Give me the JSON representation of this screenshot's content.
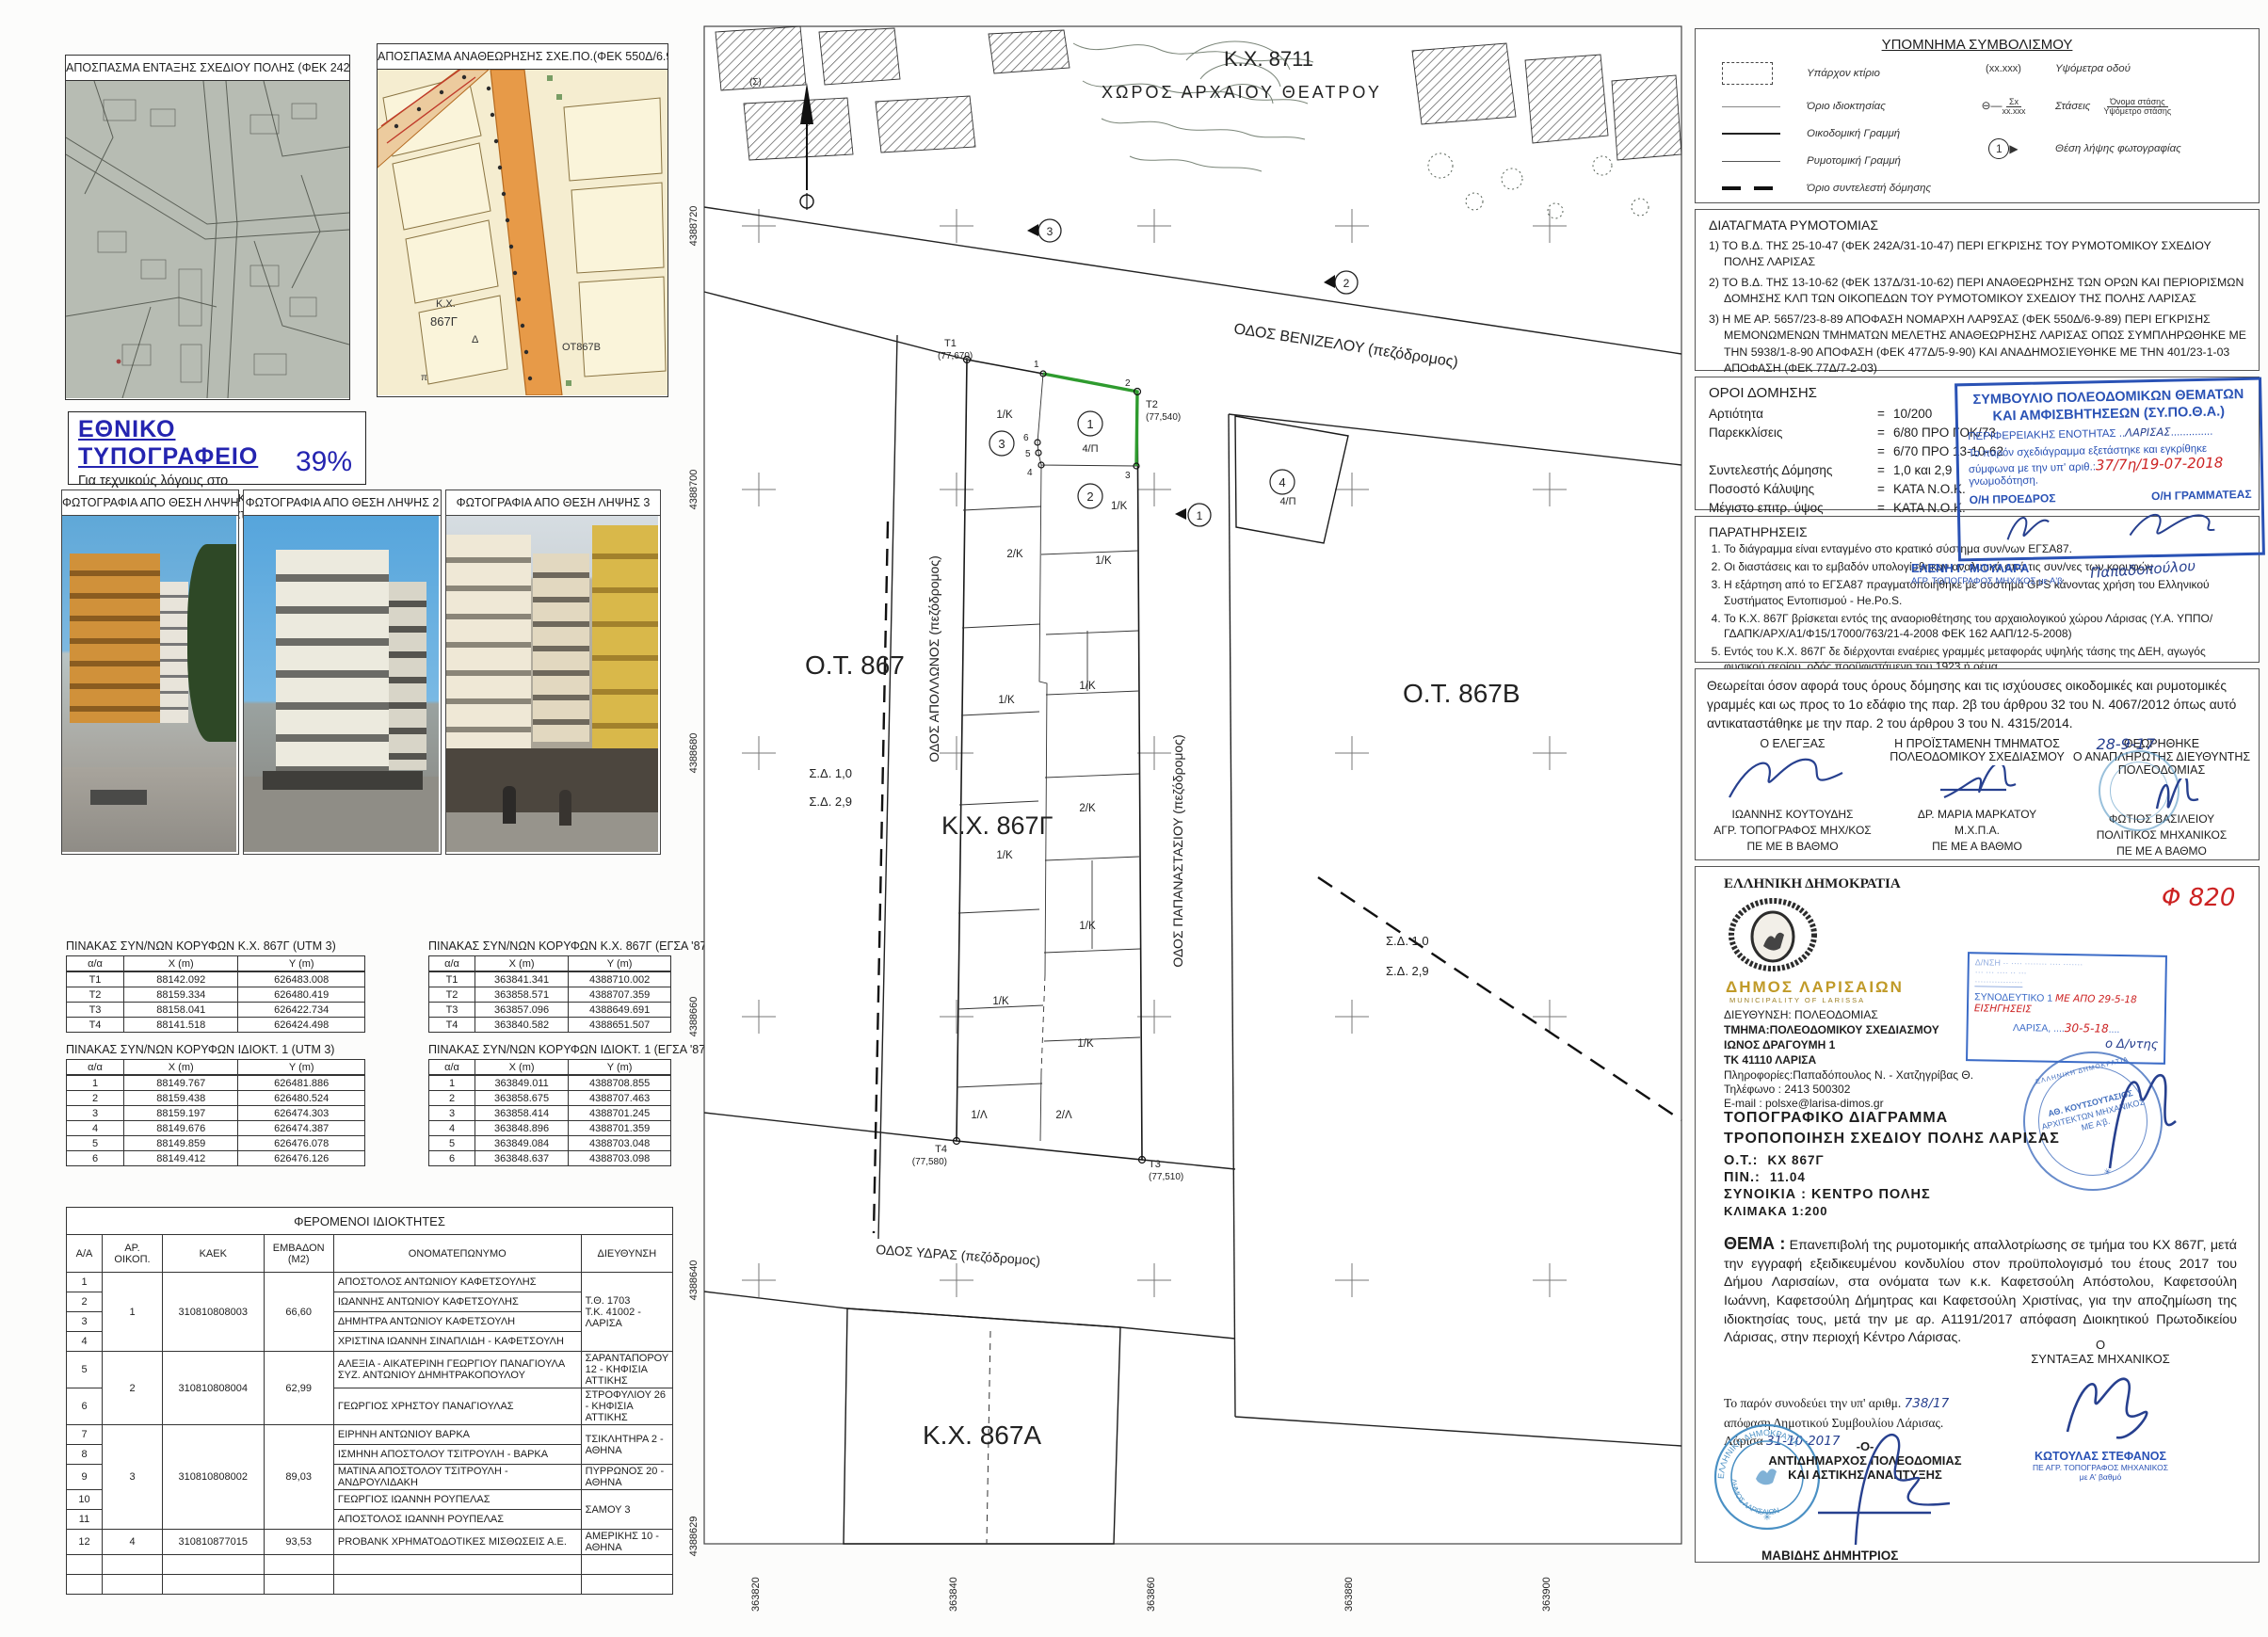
{
  "extracts": {
    "e1_title": "ΑΠΟΣΠΑΣΜΑ ΕΝΤΑΞΗΣ ΣΧΕΔΙΟΥ ΠΟΛΗΣ (ΦΕΚ 242Α/31-10-47)",
    "e2_title": "ΑΠΟΣΠΑΣΜΑ ΑΝΑΘΕΩΡΗΣΗΣ ΣΧΕ.ΠΟ.(ΦΕΚ 550Δ/6.9.89 & 77Δ/7.2.03)",
    "e2_labels": {
      "kx": "Κ.Χ.",
      "block": "867Γ",
      "d": "Δ",
      "ot": "ΟΤ867Β",
      "p": "π"
    }
  },
  "printing_note": {
    "title": "ΕΘΝΙΚΟ ΤΥΠΟΓΡΑΦΕΙΟ",
    "line1": "Για τεχνικούς λόγους στο σχεδιάγραμμα,",
    "line2": "από το ηλεκτρονικό αρχείο, έγινε",
    "line3": "σμίκρυνση κατά ποσοστό",
    "percent": "39%"
  },
  "photos": {
    "p1": "ΦΩΤΟΓΡΑΦΙΑ ΑΠΟ ΘΕΣΗ ΛΗΨΗΣ 1",
    "p2": "ΦΩΤΟΓΡΑΦΙΑ ΑΠΟ ΘΕΣΗ ΛΗΨΗΣ 2",
    "p3": "ΦΩΤΟΓΡΑΦΙΑ ΑΠΟ ΘΕΣΗ ΛΗΨΗΣ 3"
  },
  "tables": {
    "kx_utm": {
      "title": "ΠΙΝΑΚΑΣ ΣΥΝ/ΝΩΝ ΚΟΡΥΦΩΝ Κ.Χ. 867Γ  (UTM 3)",
      "headers": [
        "α/α",
        "X (m)",
        "Y (m)"
      ],
      "rows": [
        [
          "Τ1",
          "88142.092",
          "626483.008"
        ],
        [
          "Τ2",
          "88159.334",
          "626480.419"
        ],
        [
          "Τ3",
          "88158.041",
          "626422.734"
        ],
        [
          "Τ4",
          "88141.518",
          "626424.498"
        ]
      ]
    },
    "kx_egsa": {
      "title": "ΠΙΝΑΚΑΣ ΣΥΝ/ΝΩΝ ΚΟΡΥΦΩΝ Κ.Χ. 867Γ   (ΕΓΣΑ '87)",
      "headers": [
        "α/α",
        "X (m)",
        "Y (m)"
      ],
      "rows": [
        [
          "Τ1",
          "363841.341",
          "4388710.002"
        ],
        [
          "Τ2",
          "363858.571",
          "4388707.359"
        ],
        [
          "Τ3",
          "363857.096",
          "4388649.691"
        ],
        [
          "Τ4",
          "363840.582",
          "4388651.507"
        ]
      ]
    },
    "idio_utm": {
      "title": "ΠΙΝΑΚΑΣ ΣΥΝ/ΝΩΝ ΚΟΡΥΦΩΝ ΙΔΙΟΚΤ. 1  (UTM 3)",
      "headers": [
        "α/α",
        "X (m)",
        "Y (m)"
      ],
      "rows": [
        [
          "1",
          "88149.767",
          "626481.886"
        ],
        [
          "2",
          "88159.438",
          "626480.524"
        ],
        [
          "3",
          "88159.197",
          "626474.303"
        ],
        [
          "4",
          "88149.676",
          "626474.387"
        ],
        [
          "5",
          "88149.859",
          "626476.078"
        ],
        [
          "6",
          "88149.412",
          "626476.126"
        ]
      ]
    },
    "idio_egsa": {
      "title": "ΠΙΝΑΚΑΣ ΣΥΝ/ΝΩΝ ΚΟΡΥΦΩΝ ΙΔΙΟΚΤ. 1   (ΕΓΣΑ '87)",
      "headers": [
        "α/α",
        "X (m)",
        "Y (m)"
      ],
      "rows": [
        [
          "1",
          "363849.011",
          "4388708.855"
        ],
        [
          "2",
          "363858.675",
          "4388707.463"
        ],
        [
          "3",
          "363858.414",
          "4388701.245"
        ],
        [
          "4",
          "363848.896",
          "4388701.359"
        ],
        [
          "5",
          "363849.084",
          "4388703.048"
        ],
        [
          "6",
          "363848.637",
          "4388703.098"
        ]
      ]
    }
  },
  "owners": {
    "title": "ΦΕΡΟΜΕΝΟΙ ΙΔΙΟΚΤΗΤΕΣ",
    "headers": {
      "aa": "Α/Α",
      "plot": "ΑΡ. ΟΙΚΟΠ.",
      "kaek": "ΚΑΕΚ",
      "area": "ΕΜΒΑΔΟΝ (Μ2)",
      "name": "ΟΝΟΜΑΤΕΠΩΝΥΜΟ",
      "address": "ΔΙΕΥΘΥΝΣΗ"
    },
    "groups": [
      {
        "plot": "1",
        "kaek": "310810808003",
        "area": "66,60"
      },
      {
        "plot": "2",
        "kaek": "310810808004",
        "area": "62,99"
      },
      {
        "plot": "3",
        "kaek": "310810808002",
        "area": "89,03"
      },
      {
        "plot": "4",
        "kaek": "310810877015",
        "area": "93,53"
      }
    ],
    "rows": [
      {
        "aa": "1",
        "name": "ΑΠΟΣΤΟΛΟΣ ΑΝΤΩΝΙΟΥ ΚΑΦΕΤΣΟΥΛΗΣ"
      },
      {
        "aa": "2",
        "name": "ΙΩΑΝΝΗΣ ΑΝΤΩΝΙΟΥ ΚΑΦΕΤΣΟΥΛΗΣ"
      },
      {
        "aa": "3",
        "name": "ΔΗΜΗΤΡΑ ΑΝΤΩΝΙΟΥ ΚΑΦΕΤΣΟΥΛΗ"
      },
      {
        "aa": "4",
        "name": "ΧΡΙΣΤΙΝΑ ΙΩΑΝΝΗ ΣΙΝΑΠΛΙΔΗ - ΚΑΦΕΤΣΟΥΛΗ"
      },
      {
        "aa": "5",
        "name": "ΑΛΕΞΙΑ - ΑΙΚΑΤΕΡΙΝΗ ΓΕΩΡΓΙΟΥ ΠΑΝΑΓΙΟΥΛΑ ΣΥΖ. ΑΝΤΩΝΙΟΥ ΔΗΜΗΤΡΑΚΟΠΟΥΛΟΥ"
      },
      {
        "aa": "6",
        "name": "ΓΕΩΡΓΙΟΣ ΧΡΗΣΤΟΥ ΠΑΝΑΓΙΟΥΛΑΣ"
      },
      {
        "aa": "7",
        "name": "ΕΙΡΗΝΗ ΑΝΤΩΝΙΟΥ ΒΑΡΚΑ"
      },
      {
        "aa": "8",
        "name": "ΙΣΜΗΝΗ ΑΠΟΣΤΟΛΟΥ ΤΣΙΤΡΟΥΛΗ - ΒΑΡΚΑ"
      },
      {
        "aa": "9",
        "name": "ΜΑΤΙΝΑ ΑΠΟΣΤΟΛΟΥ ΤΣΙΤΡΟΥΛΗ - ΑΝΔΡΟΥΛΙΔΑΚΗ"
      },
      {
        "aa": "10",
        "name": "ΓΕΩΡΓΙΟΣ ΙΩΑΝΝΗ ΡΟΥΠΕΛΑΣ"
      },
      {
        "aa": "11",
        "name": "ΑΠΟΣΤΟΛΟΣ ΙΩΑΝΝΗ ΡΟΥΠΕΛΑΣ"
      },
      {
        "aa": "12",
        "name": "PROBANK ΧΡΗΜΑΤΟΔΟΤΙΚΕΣ ΜΙΣΘΩΣΕΙΣ Α.Ε."
      }
    ],
    "addresses": {
      "a1a": "Τ.Θ. 1703",
      "a1b": "Τ.Κ. 41002 - ΛΑΡΙΣΑ",
      "a5": "ΣΑΡΑΝΤΑΠΟΡΟΥ 12 - ΚΗΦΙΣΙΑ ΑΤΤΙΚΗΣ",
      "a6": "ΣΤΡΟΦΥΛΙΟΥ 26 - ΚΗΦΙΣΙΑ ΑΤΤΙΚΗΣ",
      "a7": "ΤΣΙΚΛΗΤΗΡΑ 2 - ΑΘΗΝΑ",
      "a9": "ΠΥΡΡΩΝΟΣ 20 - ΑΘΗΝΑ",
      "a10": "ΣΑΜΟΥ 3",
      "a12": "ΑΜΕΡΙΚΗΣ 10 - ΑΘΗΝΑ"
    }
  },
  "map": {
    "kx8711": "Κ.Χ. 8711",
    "theater": "ΧΩΡΟΣ ΑΡΧΑΙΟΥ ΘΕΑΤΡΟΥ",
    "ot867": "Ο.Τ. 867",
    "kx867g": "Κ.Χ. 867Γ",
    "ot867b": "Ο.Τ. 867Β",
    "kx867a": "Κ.Χ. 867Α",
    "st_venizelou": "ΟΔΟΣ ΒΕΝΙΖΕΛΟΥ (πεζόδρομος)",
    "st_apollonos": "ΟΔΟΣ ΑΠΟΛΛΩΝΟΣ (πεζόδρομος)",
    "st_papanastasiou": "ΟΔΟΣ ΠΑΠΑΝΑΣΤΑΣΙΟΥ (πεζόδρομος)",
    "st_ydras": "ΟΔΟΣ ΥΔΡΑΣ (πεζόδρομος)",
    "sd10": "Σ.Δ. 1,0",
    "sd29": "Σ.Δ. 2,9",
    "sigma": "(Σ)",
    "t1": "T1",
    "t1v": "(77,670)",
    "t2": "T2",
    "t2v": "(77,540)",
    "t3": "T3",
    "t3v": "(77,510)",
    "t4": "T4",
    "t4v": "(77,580)",
    "c1": "1",
    "c2": "2",
    "c3": "3",
    "c4": "4",
    "u4p": "4/Π",
    "u1k": "1/Κ",
    "u2k": "2/Κ",
    "u1l": "1/Λ",
    "u2l": "2/Λ",
    "v1": "1",
    "v2": "2",
    "v3": "3",
    "v4": "4",
    "v5": "5",
    "v6": "6",
    "axis_y": [
      "4388720",
      "4388700",
      "4388680",
      "4388660",
      "4388640",
      "4388629"
    ],
    "axis_x": [
      "363820",
      "363840",
      "363860",
      "363880",
      "363900"
    ]
  },
  "legend": {
    "title": "ΥΠΟΜΝΗΜΑ ΣΥΜΒΟΛΙΣΜΟΥ",
    "items": [
      {
        "label": "Υπάρχον κτίριο"
      },
      {
        "label": "Όριο ιδιοκτησίας"
      },
      {
        "label": "Οικοδομική Γραμμή"
      },
      {
        "label": "Ρυμοτομική Γραμμή"
      },
      {
        "label": "Όριο συντελεστή δόμησης"
      }
    ],
    "right": [
      {
        "symbol": "(xx.xxx)",
        "label": "Υψόμετρα οδού"
      },
      {
        "symbol_top": "Σx",
        "symbol_bottom": "xx.xxx",
        "label": "Στάσεις",
        "frac_top": "Όνομα στάσης",
        "frac_bottom": "Υψόμετρο στάσης"
      },
      {
        "symbol": "1",
        "label": "Θέση λήψης φωτογραφίας"
      }
    ]
  },
  "decrees": {
    "title": "ΔΙΑΤΑΓΜΑΤΑ ΡΥΜΟΤΟΜΙΑΣ",
    "items": [
      "1) ΤΟ Β.Δ. ΤΗΣ 25-10-47 (ΦΕΚ 242Α/31-10-47) ΠΕΡΙ ΕΓΚΡΙΣΗΣ ΤΟΥ ΡΥΜΟΤΟΜΙΚΟΥ ΣΧΕΔΙΟΥ ΠΟΛΗΣ ΛΑΡΙΣΑΣ",
      "2) ΤΟ Β.Δ. ΤΗΣ 13-10-62 (ΦΕΚ 137Δ/31-10-62) ΠΕΡΙ ΑΝΑΘΕΩΡΗΣΗΣ ΤΩΝ ΟΡΩΝ ΚΑΙ ΠΕΡΙΟΡΙΣΜΩΝ ΔΟΜΗΣΗΣ ΚΛΠ ΤΩΝ ΟΙΚΟΠΕΔΩΝ ΤΟΥ ΡΥΜΟΤΟΜΙΚΟΥ ΣΧΕΔΙΟΥ ΤΗΣ ΠΟΛΗΣ ΛΑΡΙΣΑΣ",
      "3) Η ΜΕ ΑΡ. 5657/23-8-89 ΑΠΟΦΑΣΗ ΝΟΜΑΡΧΗ ΛΑΡ9ΣΑΣ (ΦΕΚ 550Δ/6-9-89) ΠΕΡΙ ΕΓΚΡΙΣΗΣ ΜΕΜΟΝΩΜΕΝΩΝ ΤΜΗΜΑΤΩΝ ΜΕΛΕΤΗΣ ΑΝΑΘΕΩΡΗΣΗΣ ΛΑΡΙΣΑΣ ΟΠΩΣ ΣΥΜΠΛΗΡΩΘΗΚΕ ΜΕ ΤΗΝ 5938/1-8-90 ΑΠΟΦΑΣΗ (ΦΕΚ 477Δ/5-9-90) ΚΑΙ ΑΝΑΔΗΜΟΣΙΕΥΘΗΚΕ ΜΕ ΤΗΝ 401/23-1-03 ΑΠΟΦΑΣΗ (ΦΕΚ 77Δ/7-2-03)",
      "4) Η ΜΕ ΑΡ. 2132/31-8-00 ΑΠΟΦΑΣΗ Γ. Γ. ΠΕΡΙΦΕΡΕΙΑΣ ΘΕΣΣΑΛΙΑΣ (ΦΕΚ 653Δ/6-10-00) ΠΕΡΙ ΤΡΟΠΟΠΟΙΗΣΗΣ ΧΡΗΣΕΩΝ ΓΗΣ"
    ]
  },
  "terms": {
    "title": "ΟΡΟΙ ΔΟΜΗΣΗΣ",
    "rows": [
      {
        "label": "Αρτιότητα",
        "eq": "=",
        "value": "10/200"
      },
      {
        "label": "Παρεκκλίσεις",
        "eq": "=",
        "value": "6/80 ΠΡΟ ΓΟΚ/73"
      },
      {
        "label": "",
        "eq": "=",
        "value": "6/70 ΠΡΟ 13-10-62"
      },
      {
        "label": "Συντελεστής Δόμησης",
        "eq": "=",
        "value": "1,0 και 2,9"
      },
      {
        "label": "Ποσοστό Κάλυψης",
        "eq": "=",
        "value": "ΚΑΤΑ Ν.Ο.Κ."
      },
      {
        "label": "Μέγιστο επιτρ. ύψος",
        "eq": "=",
        "value": "ΚΑΤΑ Ν.Ο.Κ."
      },
      {
        "label": "Χρήση γης",
        "eq": "=",
        "value": "Κοινόχρηστος Χώρος"
      }
    ]
  },
  "sypotha": {
    "line1": "ΣΥΜΒΟΥΛΙΟ ΠΟΛΕΟΔΟΜΙΚΩΝ ΘΕΜΑΤΩΝ",
    "line2": "ΚΑΙ ΑΜΦΙΣΒΗΤΗΣΕΩΝ (ΣΥ.ΠΟ.Θ.Α.)",
    "line3": "ΠΕΡΙΦΕΡΕΙΑΚΗΣ ΕΝΟΤΗΤΑΣ",
    "region": "ΛΑΡΙΣΑΣ",
    "line4": "Το παρόν σχεδιάγραμμα εξετάστηκε και εγκρίθηκε",
    "line5": "σύμφωνα με την υπ' αριθ.:",
    "number": "37/7η/19-07-2018",
    "line6": "γνωμοδότηση.",
    "president": "Ο/Η ΠΡΟΕΔΡΟΣ",
    "secretary": "Ο/Η ΓΡΑΜΜΑΤΕΑΣ",
    "name1": "ΕΛΕΝΗ Γ. ΜΟΥΛΑΡΑ",
    "name1b": "ΑΓΡ. ΤΟΠΟΓΡΑΦΟΣ ΜΗΧ/ΚΟΣ με Α'β",
    "sig2": "Παπαδοπούλου"
  },
  "remarks": {
    "title": "ΠΑΡΑΤΗΡΗΣΕΙΣ",
    "items": [
      "Το διάγραμμα είναι ενταγμένο στο κρατικό σύστημα συν/νων ΕΓΣΑ87.",
      "Οι διαστάσεις και το εμβαδόν υπολογίσθηκαν αναλυτικά από τις συν/νες των κορυφών",
      "Η εξάρτηση από το ΕΓΣΑ87 πραγματοποιήθηκε με σύστημα GPS κάνοντας χρήση του Ελληνικού Συστήματος Εντοπισμού - He.Po.S.",
      "Το Κ.Χ. 867Γ βρίσκεται εντός της αναοριοθέτησης του αρχαιολογικού χώρου Λάρισας (Υ.Α. ΥΠΠΟ/ΓΔΑΠΚ/ΑΡΧ/Α1/Φ15/17000/763/21-4-2008 ΦΕΚ 162 ΑΑΠ/12-5-2008)",
      "Εντός του Κ.Χ. 867Γ δε διέρχονται εναέριες γραμμές μεταφοράς υψηλής τάσης της ΔΕΗ, αγωγός φυσικού αερίου, οδός προϋφιστάμενη του 1923 ή ρέμα.",
      "Για την ιδιοκτησία με αρ. 1 έχει εκδοθεί η με αρ. Α1191/2017 απόφαση Διοικητικού Πρωτοδικείου Λάρισας, περί άρσης ρυμοτομικής απαλλοτρίωσης."
    ]
  },
  "certify": {
    "paragraph": "Θεωρείται όσον αφορά τους όρους δόμησης και τις ισχύουσες οικοδομικές και ρυμοτομικές γραμμές και ως προς το 1ο εδάφιο της παρ. 2β του άρθρου 32 του Ν. 4067/2012 όπως αυτό αντικαταστάθηκε με την παρ. 2 του άρθρου 3 του Ν. 4315/2014.",
    "date": "28-9-17",
    "c1_role": "Ο ΕΛΕΓΞΑΣ",
    "c1_name": "ΙΩΑΝΝΗΣ ΚΟΥΤΟΥΔΗΣ",
    "c1_t1": "ΑΓΡ. ΤΟΠΟΓΡΑΦΟΣ ΜΗΧ/ΚΟΣ",
    "c1_t2": "ΠΕ ΜΕ Β ΒΑΘΜΟ",
    "c2_role1": "Η ΠΡΟΪΣΤΑΜΕΝΗ ΤΜΗΜΑΤΟΣ",
    "c2_role2": "ΠΟΛΕΟΔΟΜΙΚΟΥ ΣΧΕΔΙΑΣΜΟΥ",
    "c2_name": "ΔΡ. ΜΑΡΙΑ ΜΑΡΚΑΤΟΥ",
    "c2_t1": "Μ.Χ.Π.Α.",
    "c2_t2": "ΠΕ ΜΕ Α ΒΑΘΜΟ",
    "c3_role0": "ΘΕΩΡΗΘΗΚΕ",
    "c3_role1": "Ο ΑΝΑΠΛΗΡΩΤΗΣ ΔΙΕΥΘΥΝΤΗΣ",
    "c3_role2": "ΠΟΛΕΟΔΟΜΙΑΣ",
    "c3_name": "ΦΩΤΙΟΣ ΒΑΣΙΛΕΙΟΥ",
    "c3_t1": "ΠΟΛΙΤΙΚΟΣ ΜΗΧΑΝΙΚΟΣ",
    "c3_t2": "ΠΕ ΜΕ Α ΒΑΘΜΟ"
  },
  "letterhead": {
    "state": "ΕΛΛΗΝΙΚΗ ΔΗΜΟΚΡΑΤΙΑ",
    "muni": "ΔΗΜΟΣ ΛΑΡΙΣΑΙΩΝ",
    "muni_en": "MUNICIPALITY OF LARISSA",
    "dir": "ΔΙΕΥΘΥΝΣΗ: ΠΟΛΕΟΔΟΜΙΑΣ",
    "dept": "ΤΜΗΜΑ:ΠΟΛΕΟΔΟΜΙΚΟΥ  ΣΧΕΔΙΑΣΜΟΥ",
    "addr1": "ΙΩΝΟΣ ΔΡΑΓΟΥΜΗ 1",
    "addr2": "ΤΚ 41110  ΛΑΡΙΣΑ",
    "info": "Πληροφορίες:Παπαδόπουλος Ν. - Χατζηγρίβας Θ.",
    "tel": "Τηλέφωνο :   2413 500302",
    "email": "E-mail      : polsxe@larisa-dimos.gr",
    "file_no": "Φ 820"
  },
  "accompany_stamp": {
    "synod": "ΣΥΝΟΔΕΥΤΙΚΟ 1",
    "red1": "ΜΕ ΑΠΟ 29-5-18 ΕΙΣΗΓΗΣΕΙΣ",
    "city": "ΛΑΡΙΣΑ, ",
    "red2": "30-5-18",
    "script": "ο Δ/ντης"
  },
  "arch_stamp": {
    "name": "ΑΘ. ΚΟΥΤΣΟΥΤΑΣΙΟΣ",
    "t1": "ΑΡΧΙΤΕΚΤΩΝ ΜΗΧΑΝΙΚΟΣ",
    "t2": "ΜΕ Α'β.",
    "ring": "ΕΛΛΗΝΙΚΗ ΔΗΜΟΚΡΑΤΙΑ"
  },
  "titleblock": {
    "l1": "ΤΟΠΟΓΡΑΦΙΚΟ  ΔΙΑΓΡΑΜΜΑ",
    "l2": "ΤΡΟΠΟΠΟΙΗΣΗ  ΣΧΕΔΙΟΥ  ΠΟΛΗΣ  ΛΑΡΙΣΑΣ",
    "ot_label": "Ο.Τ.:",
    "ot": "ΚΧ 867Γ",
    "pin_label": "ΠΙΝ.:",
    "pin": "11.04",
    "syn": "ΣΥΝΟΙΚΙΑ : ΚΕΝΤΡΟ ΠΟΛΗΣ",
    "scale": "ΚΛΙΜΑΚΑ 1:200"
  },
  "thema": {
    "label": "ΘΕΜΑ :",
    "text": "Επανεπιβολή  της ρυμοτομικής απαλλοτρίωσης σε τμήμα του ΚΧ 867Γ, μετά την εγγραφή εξειδικευμένου κονδυλίου στον προϋπολογισμό του έτους 2017 του Δήμου Λαρισαίων, στα ονόματα των κ.κ. Καφετσούλη Απόστολου, Καφετσούλη Ιωάννη, Καφετσούλη Δήμητρας και Καφετσούλη Χριστίνας, για την αποζημίωση της ιδιοκτησίας τους, μετά την με αρ. Α1191/2017 απόφαση Διοικητικού Πρωτοδικείου Λάρισας, στην περιοχή Κέντρο Λάρισας."
  },
  "bottom": {
    "acc1": "Το παρόν συνοδεύει την υπ' αριθμ.",
    "acc_no": "738/17",
    "acc2": "απόφαση Δημοτικού Συμβουλίου Λάρισας.",
    "acc3": "Λάρισα",
    "acc_date": "31-10-2017",
    "eng_o": "Ο",
    "eng_role": "ΣΥΝΤΑΞΑΣ  ΜΗΧΑΝΙΚΟΣ",
    "eng_name": "ΚΩΤΟΥΛΑΣ ΣΤΕΦΑΝΟΣ",
    "eng_t1": "ΠΕ ΑΓΡ. ΤΟΠΟΓΡΑΦΟΣ ΜΗΧΑΝΙΚΟΣ",
    "eng_t2": "με Α' βαθμό",
    "dep_o": "-Ο-",
    "dep_r1": "ΑΝΤΙΔΗΜΑΡΧΟΣ ΠΟΛΕΟΔΟΜΙΑΣ",
    "dep_r2": "ΚΑΙ ΑΣΤΙΚΗΣ ΑΝΑΠΤΥΞΗΣ",
    "dep_name": "ΜΑΒΙΔΗΣ ΔΗΜΗΤΡΙΟΣ",
    "stamp_muni1": "ΕΛΛΗΝΙΚΗ ΔΗΜΟΚΡΑΤΙΑ",
    "stamp_muni2": "ΔΗΜΟΣ ΛΑΡΙΣΑΙΩΝ"
  }
}
